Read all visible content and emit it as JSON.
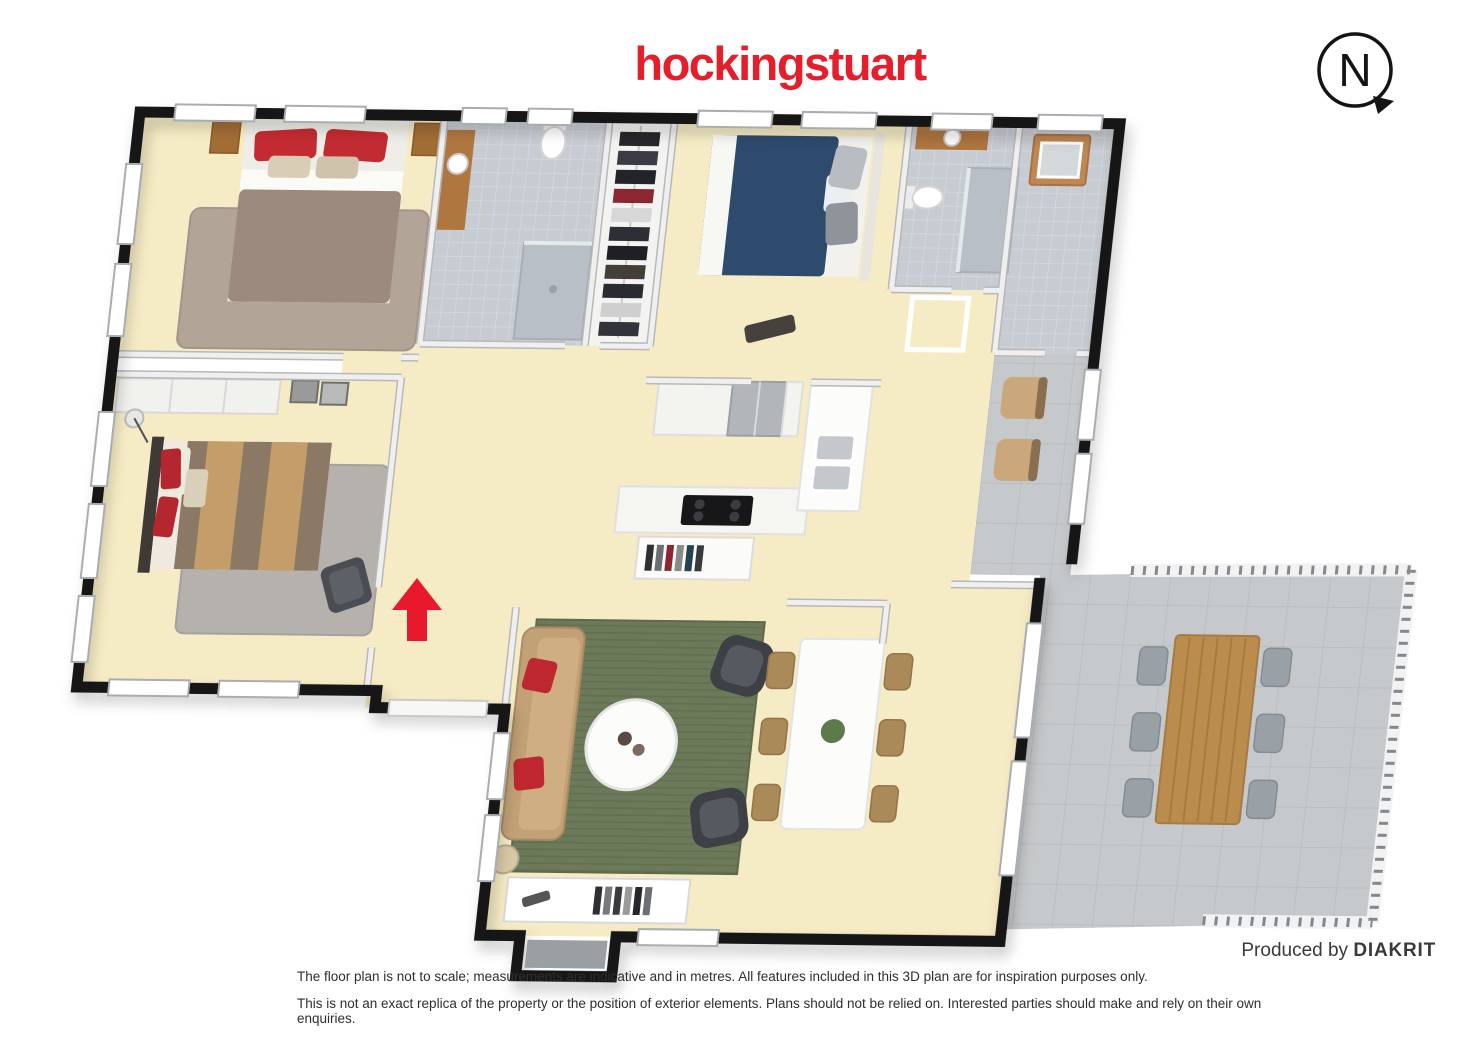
{
  "header": {
    "logo_text": "hockingstuart",
    "logo_color": "#e41e2b"
  },
  "compass": {
    "label": "N",
    "pointer_direction": "lower-right"
  },
  "footer": {
    "produced_by_prefix": "Produced by",
    "produced_by_brand": "DIAKRIT",
    "disclaimer_line1": "The floor plan is not to scale; measurements are indicative and in metres. All features included in this 3D plan are for inspiration purposes only.",
    "disclaimer_line2": "This is not an exact replica of the property or the position of exterior elements. Plans should not be relied on. Interested parties should make and rely on their own enquiries."
  },
  "floorplan": {
    "entrance_arrow_color": "#e8192c",
    "palette": {
      "wall_black": "#151515",
      "interior_wall": "#efefef",
      "floor_cream": "#f5ebc4",
      "bathroom_tile": "#c7ccd2",
      "paver_gray": "#c6c9cb",
      "rug_green": "#6c795a",
      "rug_taupe": "#b2a496",
      "rug_gray": "#b5b1ac",
      "bed_navy": "#2e4a6c",
      "duvet_taupe": "#9b8a7d",
      "sofa_tan": "#c2a176",
      "pillow_red": "#c22b31",
      "timber": "#b0763f",
      "outdoor_table_wood": "#ba8c4e",
      "armchair_dark": "#3d4045"
    },
    "rooms": [
      "master-bedroom",
      "ensuite-bathroom",
      "walk-in-robe",
      "bedroom-2",
      "bathroom-2",
      "laundry",
      "verandah",
      "bedroom-3",
      "entry",
      "kitchen",
      "living-room",
      "dining-area",
      "patio-deck"
    ]
  }
}
